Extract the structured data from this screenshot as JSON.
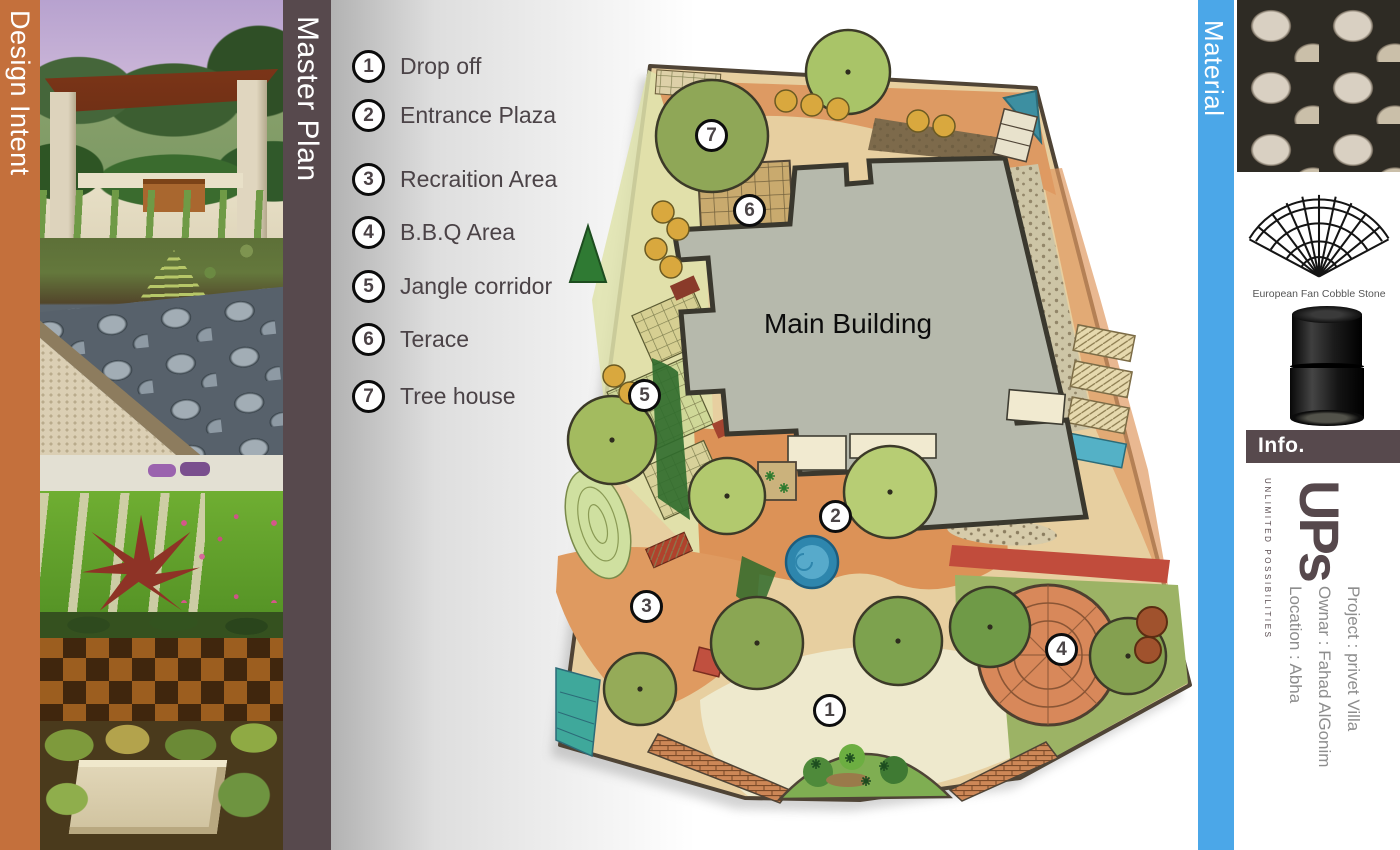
{
  "sidebars": {
    "design_intent": {
      "label": "Design Intent",
      "color": "#c4703c"
    },
    "master_plan": {
      "label": "Master Plan",
      "color": "#57494d"
    },
    "material": {
      "label": "Material",
      "color": "#4ba7e8"
    },
    "info": {
      "label": "Info.",
      "color": "#57494d"
    }
  },
  "legend": {
    "items": [
      {
        "number": "1",
        "label": "Drop off"
      },
      {
        "number": "2",
        "label": "Entrance Plaza"
      },
      {
        "number": "3",
        "label": "Recraition Area"
      },
      {
        "number": "4",
        "label": "B.B.Q Area"
      },
      {
        "number": "5",
        "label": "Jangle corridor"
      },
      {
        "number": "6",
        "label": "Terace"
      },
      {
        "number": "7",
        "label": "Tree house"
      }
    ]
  },
  "plan": {
    "building_label": "Main Building",
    "markers": [
      {
        "number": "1"
      },
      {
        "number": "2"
      },
      {
        "number": "3"
      },
      {
        "number": "4"
      },
      {
        "number": "5"
      },
      {
        "number": "6"
      },
      {
        "number": "7"
      }
    ]
  },
  "material_panel": {
    "fan_caption": "European Fan Cobble Stone"
  },
  "branding": {
    "logo": "UPs",
    "tagline": "UNLIMITED POSSIBILITIES"
  },
  "project_info": {
    "line1": "Project : privet Villa",
    "line2": "Ownar : Fahad AlGonim",
    "line3": "Location : Abha"
  }
}
